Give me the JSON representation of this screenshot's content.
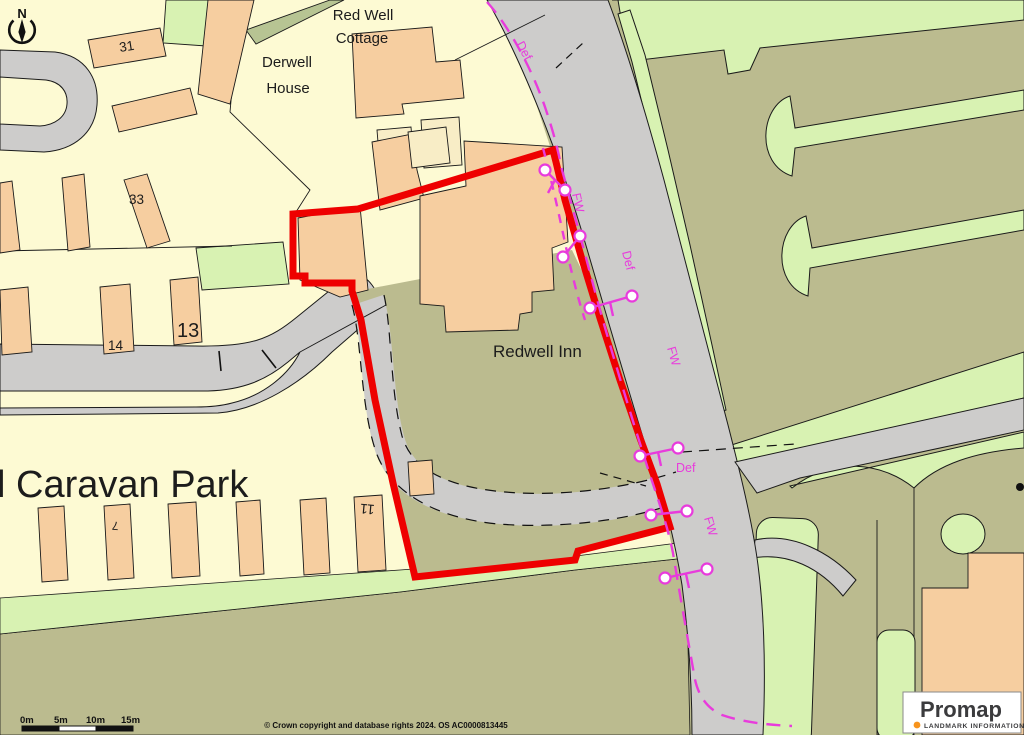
{
  "compass": {
    "north_label": "N"
  },
  "map_labels": {
    "red_well_cottage_line1": "Red Well",
    "red_well_cottage_line2": "Cottage",
    "derwell_house_line1": "Derwell",
    "derwell_house_line2": "House",
    "redwell_inn": "Redwell Inn",
    "caravan_park": "l Caravan Park",
    "num_31": "31",
    "num_33": "33",
    "num_14": "14",
    "num_13": "13",
    "num_7": "7",
    "num_11": "11"
  },
  "boundary_labels": {
    "def_top": "Def",
    "def_mid": "Def",
    "def_junction": "Def",
    "fw_top": "FW",
    "fw_mid": "FW",
    "fw_lower": "FW"
  },
  "scale_bar": {
    "labels": [
      "0m",
      "5m",
      "10m",
      "15m"
    ]
  },
  "footer": {
    "copyright": "© Crown copyright and database rights 2024. OS AC0000813445"
  },
  "logo": {
    "brand": "Promap",
    "tagline": "LANDMARK INFORMATION"
  },
  "colors": {
    "background": "#FDFAD3",
    "building_peach": "#F6CEA0",
    "building_cream": "#F8EDC6",
    "road_gray": "#CDCCCB",
    "verge_olive": "#BBBB8F",
    "field_green": "#D8F2B2",
    "field_bright_green": "#C9EF9F",
    "hedge_green": "#B7C493",
    "site_boundary_red": "#EE0000",
    "admin_boundary_magenta": "#E83BDC",
    "promap_text": "#3B3B3D",
    "promap_orange": "#F7941D"
  }
}
